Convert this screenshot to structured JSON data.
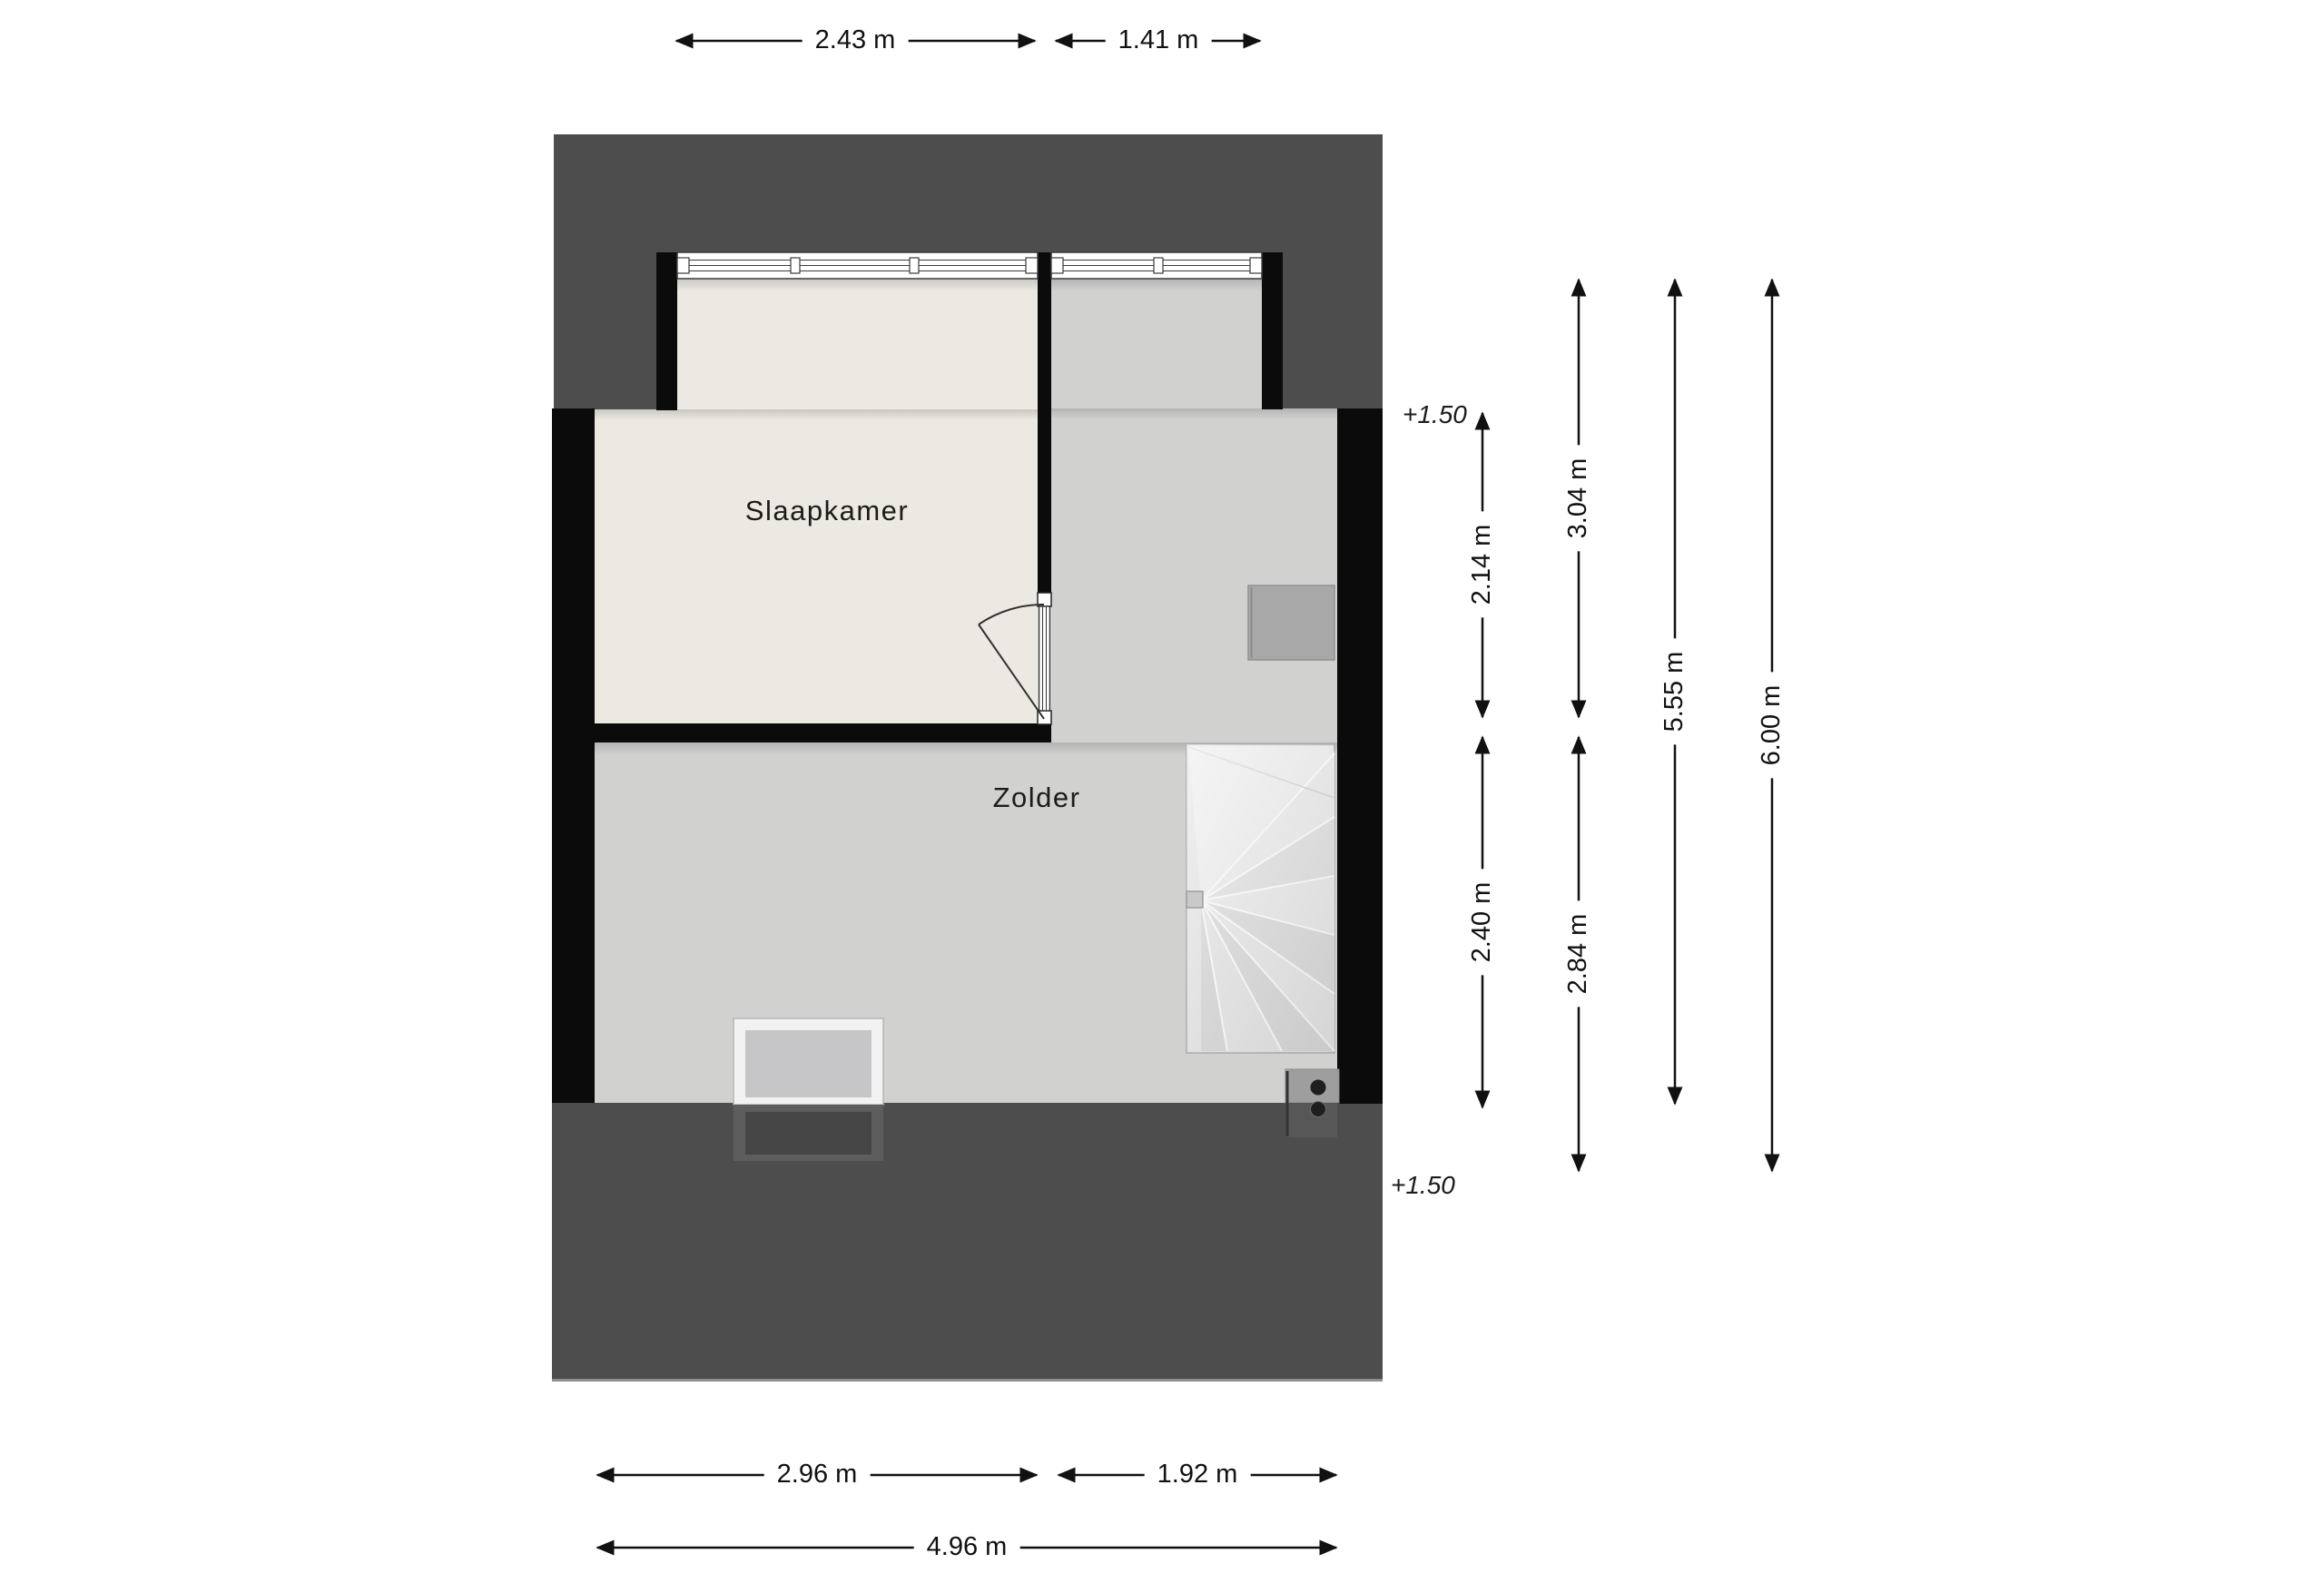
{
  "plan_title": "attic floor plan",
  "rooms": {
    "slaapkamer": {
      "label": "Slaapkamer"
    },
    "zolder": {
      "label": "Zolder"
    }
  },
  "levels": {
    "top": {
      "label": "+1.50"
    },
    "bottom": {
      "label": "+1.50"
    }
  },
  "dimensions": {
    "top": [
      {
        "label": "2.43 m"
      },
      {
        "label": "1.41 m"
      }
    ],
    "right": [
      {
        "label": "2.14 m"
      },
      {
        "label": "2.40 m"
      },
      {
        "label": "3.04 m"
      },
      {
        "label": "2.84 m"
      },
      {
        "label": "5.55 m"
      },
      {
        "label": "6.00 m"
      }
    ],
    "bottom": [
      {
        "label": "2.96 m"
      },
      {
        "label": "1.92 m"
      },
      {
        "label": "4.96 m"
      }
    ]
  },
  "colors": {
    "roof": "#4d4d4d",
    "wall": "#0b0b0b",
    "slaapkamer_floor": "#ebe9e1",
    "zolder_floor": "#d1d1cf",
    "stairs": "#e0e0e0",
    "cabinet": "#a8a8a8",
    "dimension_ink": "#111111",
    "background": "#ffffff"
  }
}
